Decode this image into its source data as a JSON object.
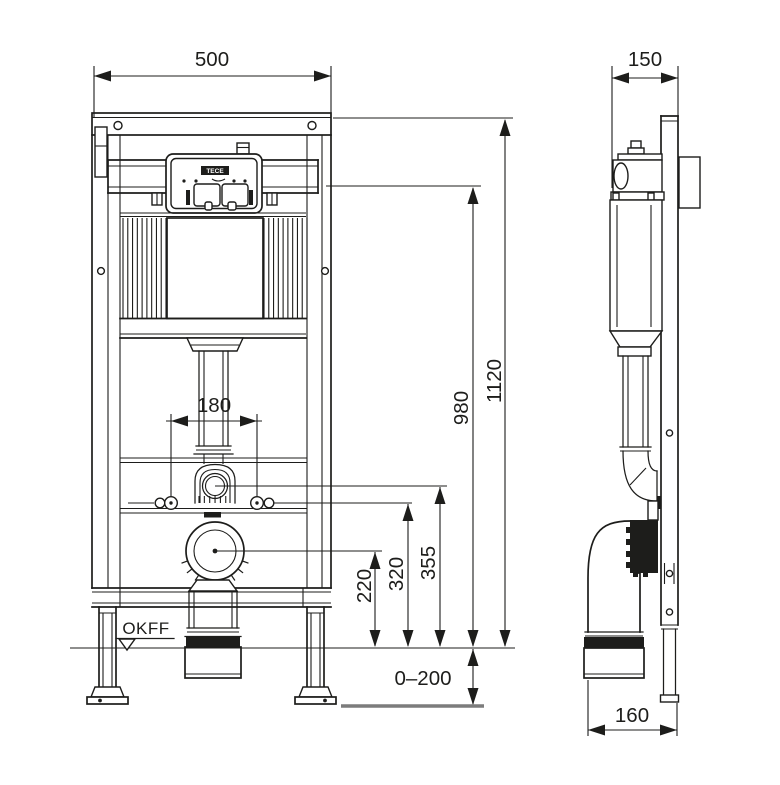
{
  "meta": {
    "description": "Dimensioned technical drawing of a wall-mounted WC installation frame with concealed cistern, front view and side view",
    "brand": "TECE",
    "views": [
      "front",
      "side"
    ]
  },
  "labels": {
    "front_width": "500",
    "bolt_spacing": "180",
    "height_total": "1120",
    "height_actuation": "980",
    "height_flush_bend": "355",
    "height_fixing": "320",
    "height_drain": "220",
    "floor_adjust": "0–200",
    "floor_level": "OKFF",
    "depth": "150",
    "drain_offset": "160",
    "logo": "TECE"
  },
  "colors": {
    "line": "#1d1d1b",
    "slab_line": "#7c7c7c",
    "background": "#ffffff"
  }
}
